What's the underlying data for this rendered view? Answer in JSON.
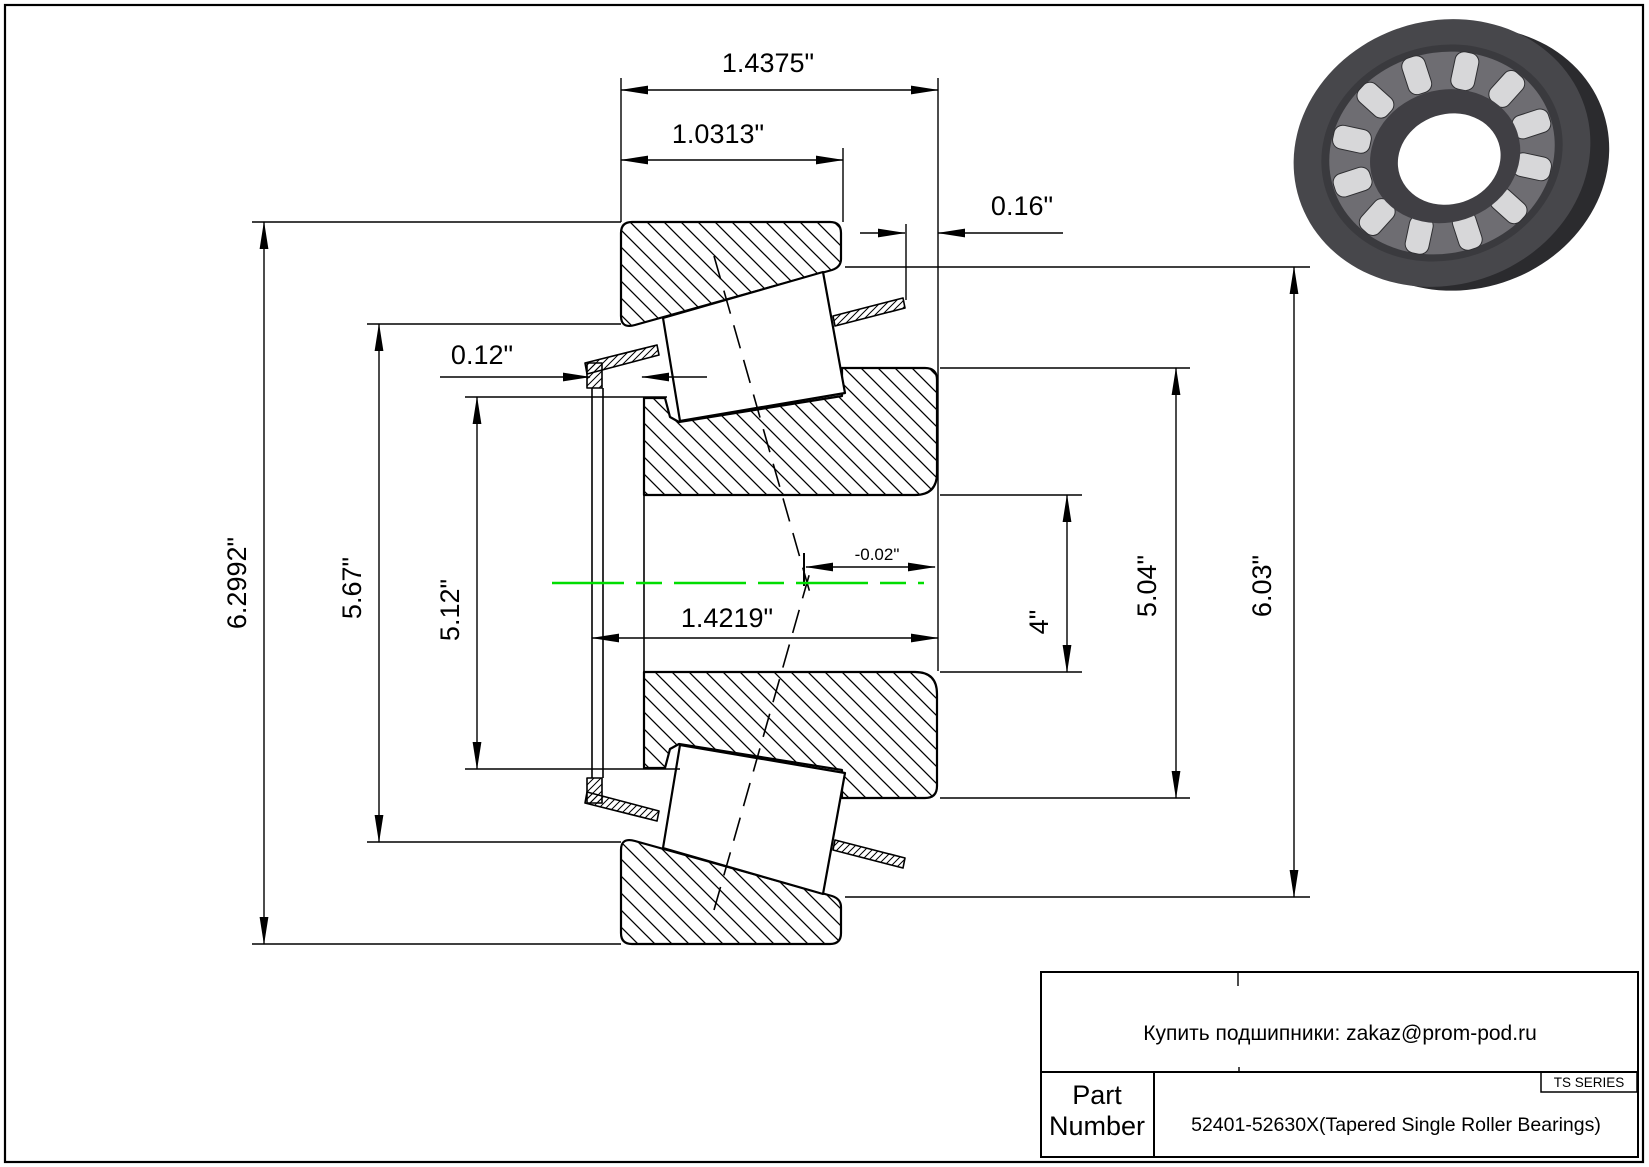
{
  "page": {
    "centerline_color": "#00dd00",
    "line_color": "#000000"
  },
  "dimensions": {
    "overall_width": "1.4375\"",
    "cup_width": "1.0313\"",
    "stand_out": "0.16\"",
    "cage_clearance": "0.12\"",
    "effective_center": "-0.02\"",
    "cone_width": "1.4219\"",
    "cup_outer_diameter": "6.2992\"",
    "race_small_diameter": "5.67\"",
    "cage_diameter": "5.12\"",
    "bore_diameter": "4\"",
    "rib_diameter": "5.04\"",
    "race_large_diameter": "6.03\""
  },
  "title_block": {
    "contact_line": "Купить подшипники: zakaz@prom-pod.ru",
    "series_badge": "TS SERIES",
    "part_label_line1": "Part",
    "part_label_line2": "Number",
    "part_number": "52401-52630X(Tapered Single Roller Bearings)"
  }
}
